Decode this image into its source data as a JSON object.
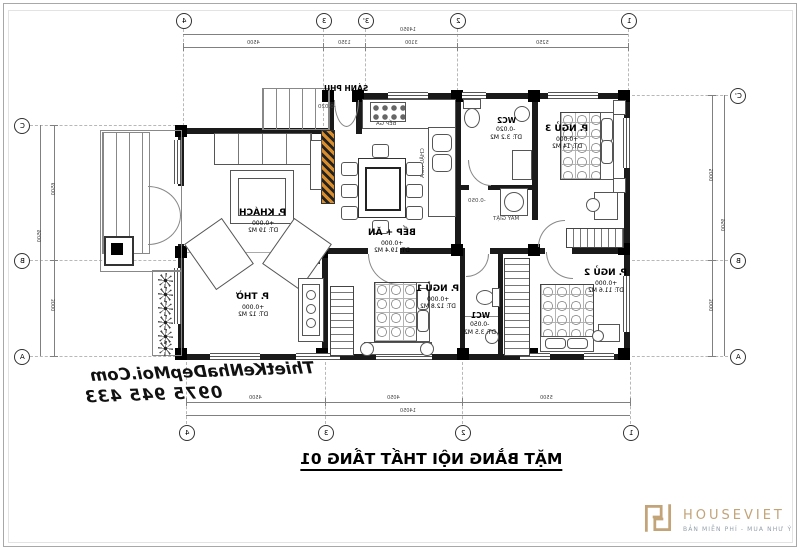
{
  "title": "MẶT BẰNG NỘI THẤT TẦNG 01",
  "watermark": {
    "line1": "ThietKeNhaDepMoi.Com",
    "line2": "0975 945 433"
  },
  "logo": {
    "name": "HOUSEVIET",
    "tagline": "BẢN MIỄN PHÍ - MUA NHƯ Ý"
  },
  "colors": {
    "hatch_accent": "#d98e2b",
    "logo_gold": "#c2a478",
    "logo_tagline_gray": "#94a0ac",
    "line_black": "#1a1a1a"
  },
  "grid": {
    "top": [
      "4",
      "3",
      "3'",
      "2",
      "1"
    ],
    "bottom": [
      "4",
      "3",
      "2",
      "1"
    ],
    "left": [
      "C",
      "B",
      "A"
    ],
    "right": [
      "C'",
      "B",
      "A"
    ]
  },
  "dims": {
    "top_total": "14950",
    "top_segments": [
      "4500",
      "1350",
      "3100",
      "5250"
    ],
    "bottom_segments": [
      "4500",
      "4050",
      "5500"
    ],
    "bottom_total": "14050",
    "left_segments": [
      "6500",
      "3000"
    ],
    "left_total": "9500",
    "right_segments": [
      "5000",
      "3000"
    ],
    "right_total": "9500"
  },
  "rooms": {
    "khach": {
      "name": "P. KHÁCH",
      "level": "+0.000",
      "area": "DT: 19 M2"
    },
    "bep_an": {
      "name": "BẾP + ĂN",
      "level": "+0.000",
      "area": "DT: 19.4 M2"
    },
    "sanh_phu": {
      "name": "SẢNH PHỤ",
      "level": "-0.020"
    },
    "wc2": {
      "name": "WC2",
      "level": "-0.020",
      "area": "DT: 3.2 M2"
    },
    "ngu3": {
      "name": "P. NGỦ 3",
      "level": "+0.000",
      "area": "DT: 14 M2"
    },
    "ngu2": {
      "name": "P. NGỦ 2",
      "level": "+0.000",
      "area": "DT: 11.6 M2"
    },
    "ngu1": {
      "name": "P. NGỦ 1",
      "level": "+0.000",
      "area": "DT: 12.8 M2"
    },
    "wc1": {
      "name": "WC1",
      "level": "-0.050",
      "area": "DT: 3.5 M2"
    },
    "tho": {
      "name": "P. THỜ",
      "level": "+0.000",
      "area": "DT: 12 M2"
    }
  },
  "annotations": {
    "bep_ga": "BẾP GA",
    "chau_rua": "CHẬU RỬA",
    "may_giat": "MÁY GIẶT",
    "may_giat_level": "-0.050"
  }
}
